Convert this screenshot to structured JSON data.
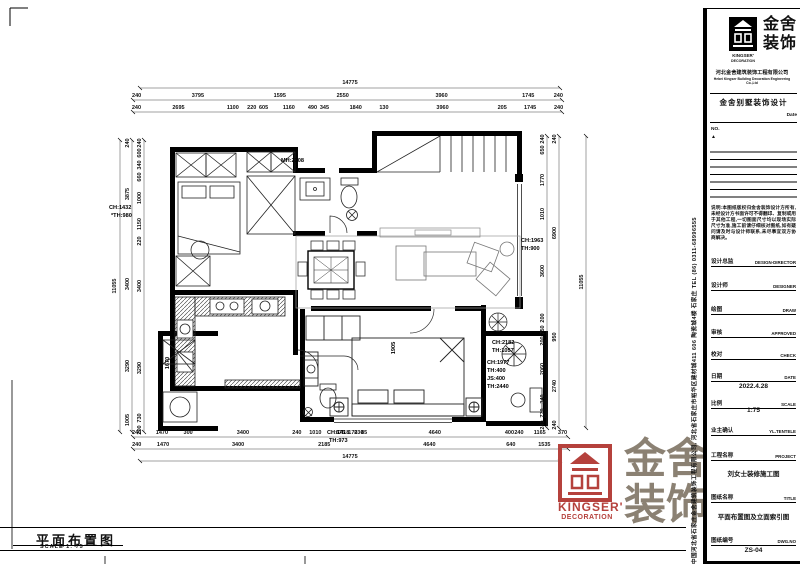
{
  "sheet": {
    "bottom_title": "平面布置图",
    "bottom_scale": "SCALE 1: 75"
  },
  "watermark": {
    "brand_line1": "金舍",
    "brand_line2": "装饰",
    "en_line1": "KINGSER'",
    "en_line2": "DECORATION",
    "red": "#b5413c",
    "gray": "#8b8173"
  },
  "titleblock": {
    "brand_cn_line1": "金舍",
    "brand_cn_line2": "装饰",
    "brand_en_line1": "KINGSER'",
    "brand_en_line2": "DECORATION",
    "company_cn": "河北金舍建筑装饰工程有限公司",
    "company_en": "Hebei Kingser Building Decoration Engineering Co.,Ltd",
    "dept_title": "金舍别墅装饰设计",
    "date_label": "Date",
    "no_label": "NO.",
    "rev_mark": "▲",
    "notes": "说明:本图纸版权归金舍装饰设计方所有,未经设计方书面许可不得翻印、复制或用于其他工程,一切图面尺寸均以现场实际尺寸为准,施工前请仔细核对图纸,如有疑问请及时与设计师联系,未尽事宜双方协商解决。",
    "side_text": "中国河北省石家庄金舍建筑装饰工程有限公司, 河北省石家庄市裕华区建材城411 606 陶瓷城4楼 石家庄 TEL (86) 0311-68996555",
    "fields": [
      {
        "cn": "设计总监",
        "en": "DESIGN-DIRECTOR",
        "value": ""
      },
      {
        "cn": "设计师",
        "en": "DESIGNER",
        "value": ""
      },
      {
        "cn": "绘图",
        "en": "DRAW",
        "value": ""
      },
      {
        "cn": "审核",
        "en": "APPROVED",
        "value": ""
      },
      {
        "cn": "校对",
        "en": "CHECK",
        "value": ""
      },
      {
        "cn": "日期",
        "en": "DATE",
        "value": "2022.4.28"
      },
      {
        "cn": "比例",
        "en": "SCALE",
        "value": "1:75"
      },
      {
        "cn": "业主确认",
        "en": "YL.TENTELE",
        "value": ""
      },
      {
        "cn": "工程名称",
        "en": "PROJECT",
        "value": "刘女士装修施工图"
      },
      {
        "cn": "图纸名称",
        "en": "TITLE",
        "value": "平面布置图及立面索引图"
      },
      {
        "cn": "图纸编号",
        "en": "DWG.NO",
        "value": "ZS-04"
      }
    ]
  },
  "plan": {
    "dims": {
      "top_total": "14775",
      "top_row1": [
        "240",
        "3795",
        "1595",
        "2550",
        "3960",
        "1745",
        "240"
      ],
      "top_row2": [
        "240",
        "2695",
        "1100",
        "220",
        "605",
        "1160",
        "490",
        "345",
        "1840",
        "130",
        "3960",
        "205",
        "1745",
        "240"
      ],
      "bottom_row1": [
        "240",
        "1470",
        "300",
        "3400",
        "240",
        "1010",
        "675",
        "170",
        "230",
        "85",
        "4640",
        "400",
        "240",
        "1165",
        "370"
      ],
      "bottom_row2": [
        "240",
        "1470",
        "3400",
        "2185",
        "4640",
        "640",
        "1535"
      ],
      "bottom_total": "14775",
      "left_total": "11055",
      "left_mid": [
        "240",
        "3875",
        "3400",
        "3290",
        "1005"
      ],
      "left_inner": [
        "240",
        "600",
        "340",
        "660",
        "1000",
        "1150",
        "220",
        "3400",
        "3290",
        "730",
        "200"
      ],
      "right_inner": [
        "240",
        "650",
        "1770",
        "1010",
        "3600",
        "200",
        "750",
        "200",
        "2060",
        "340",
        "770",
        "240"
      ],
      "right_outer": [
        "240",
        "6900",
        "950",
        "2740",
        "240"
      ],
      "right_total": "11055"
    },
    "labels": [
      {
        "text": "MH:2308"
      },
      {
        "text": "CH:1432"
      },
      {
        "text": "*TH:980"
      },
      {
        "text": "CH:1963"
      },
      {
        "text": "TH:900"
      },
      {
        "text": "CH:2182"
      },
      {
        "text": "TH:1057"
      },
      {
        "text": "CH:1977"
      },
      {
        "text": "TH:400"
      },
      {
        "text": "JS:400"
      },
      {
        "text": "TH:2440"
      },
      {
        "text": "CH:1418"
      },
      {
        "text": "TH:973"
      },
      {
        "text": "1905"
      },
      {
        "text": "1670"
      }
    ]
  }
}
